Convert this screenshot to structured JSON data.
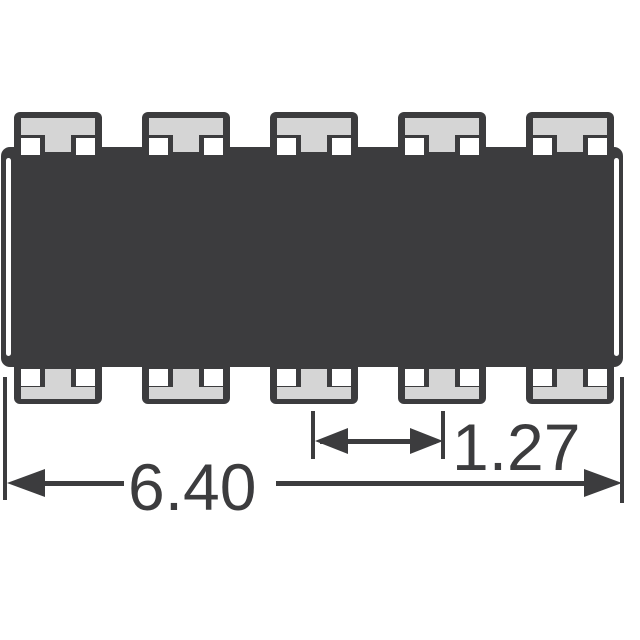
{
  "figure": {
    "type": "component-package-outline-drawing",
    "body": {
      "pin_count_top": 5,
      "pin_count_bottom": 5
    },
    "dimensions": {
      "pitch": {
        "label": "1.27"
      },
      "length": {
        "label": "6.40"
      }
    },
    "colors": {
      "outline": "#3c3c3e",
      "pad_fill": "#d5d5d5",
      "notch_fill": "#ffffff",
      "background": "#ffffff"
    }
  }
}
